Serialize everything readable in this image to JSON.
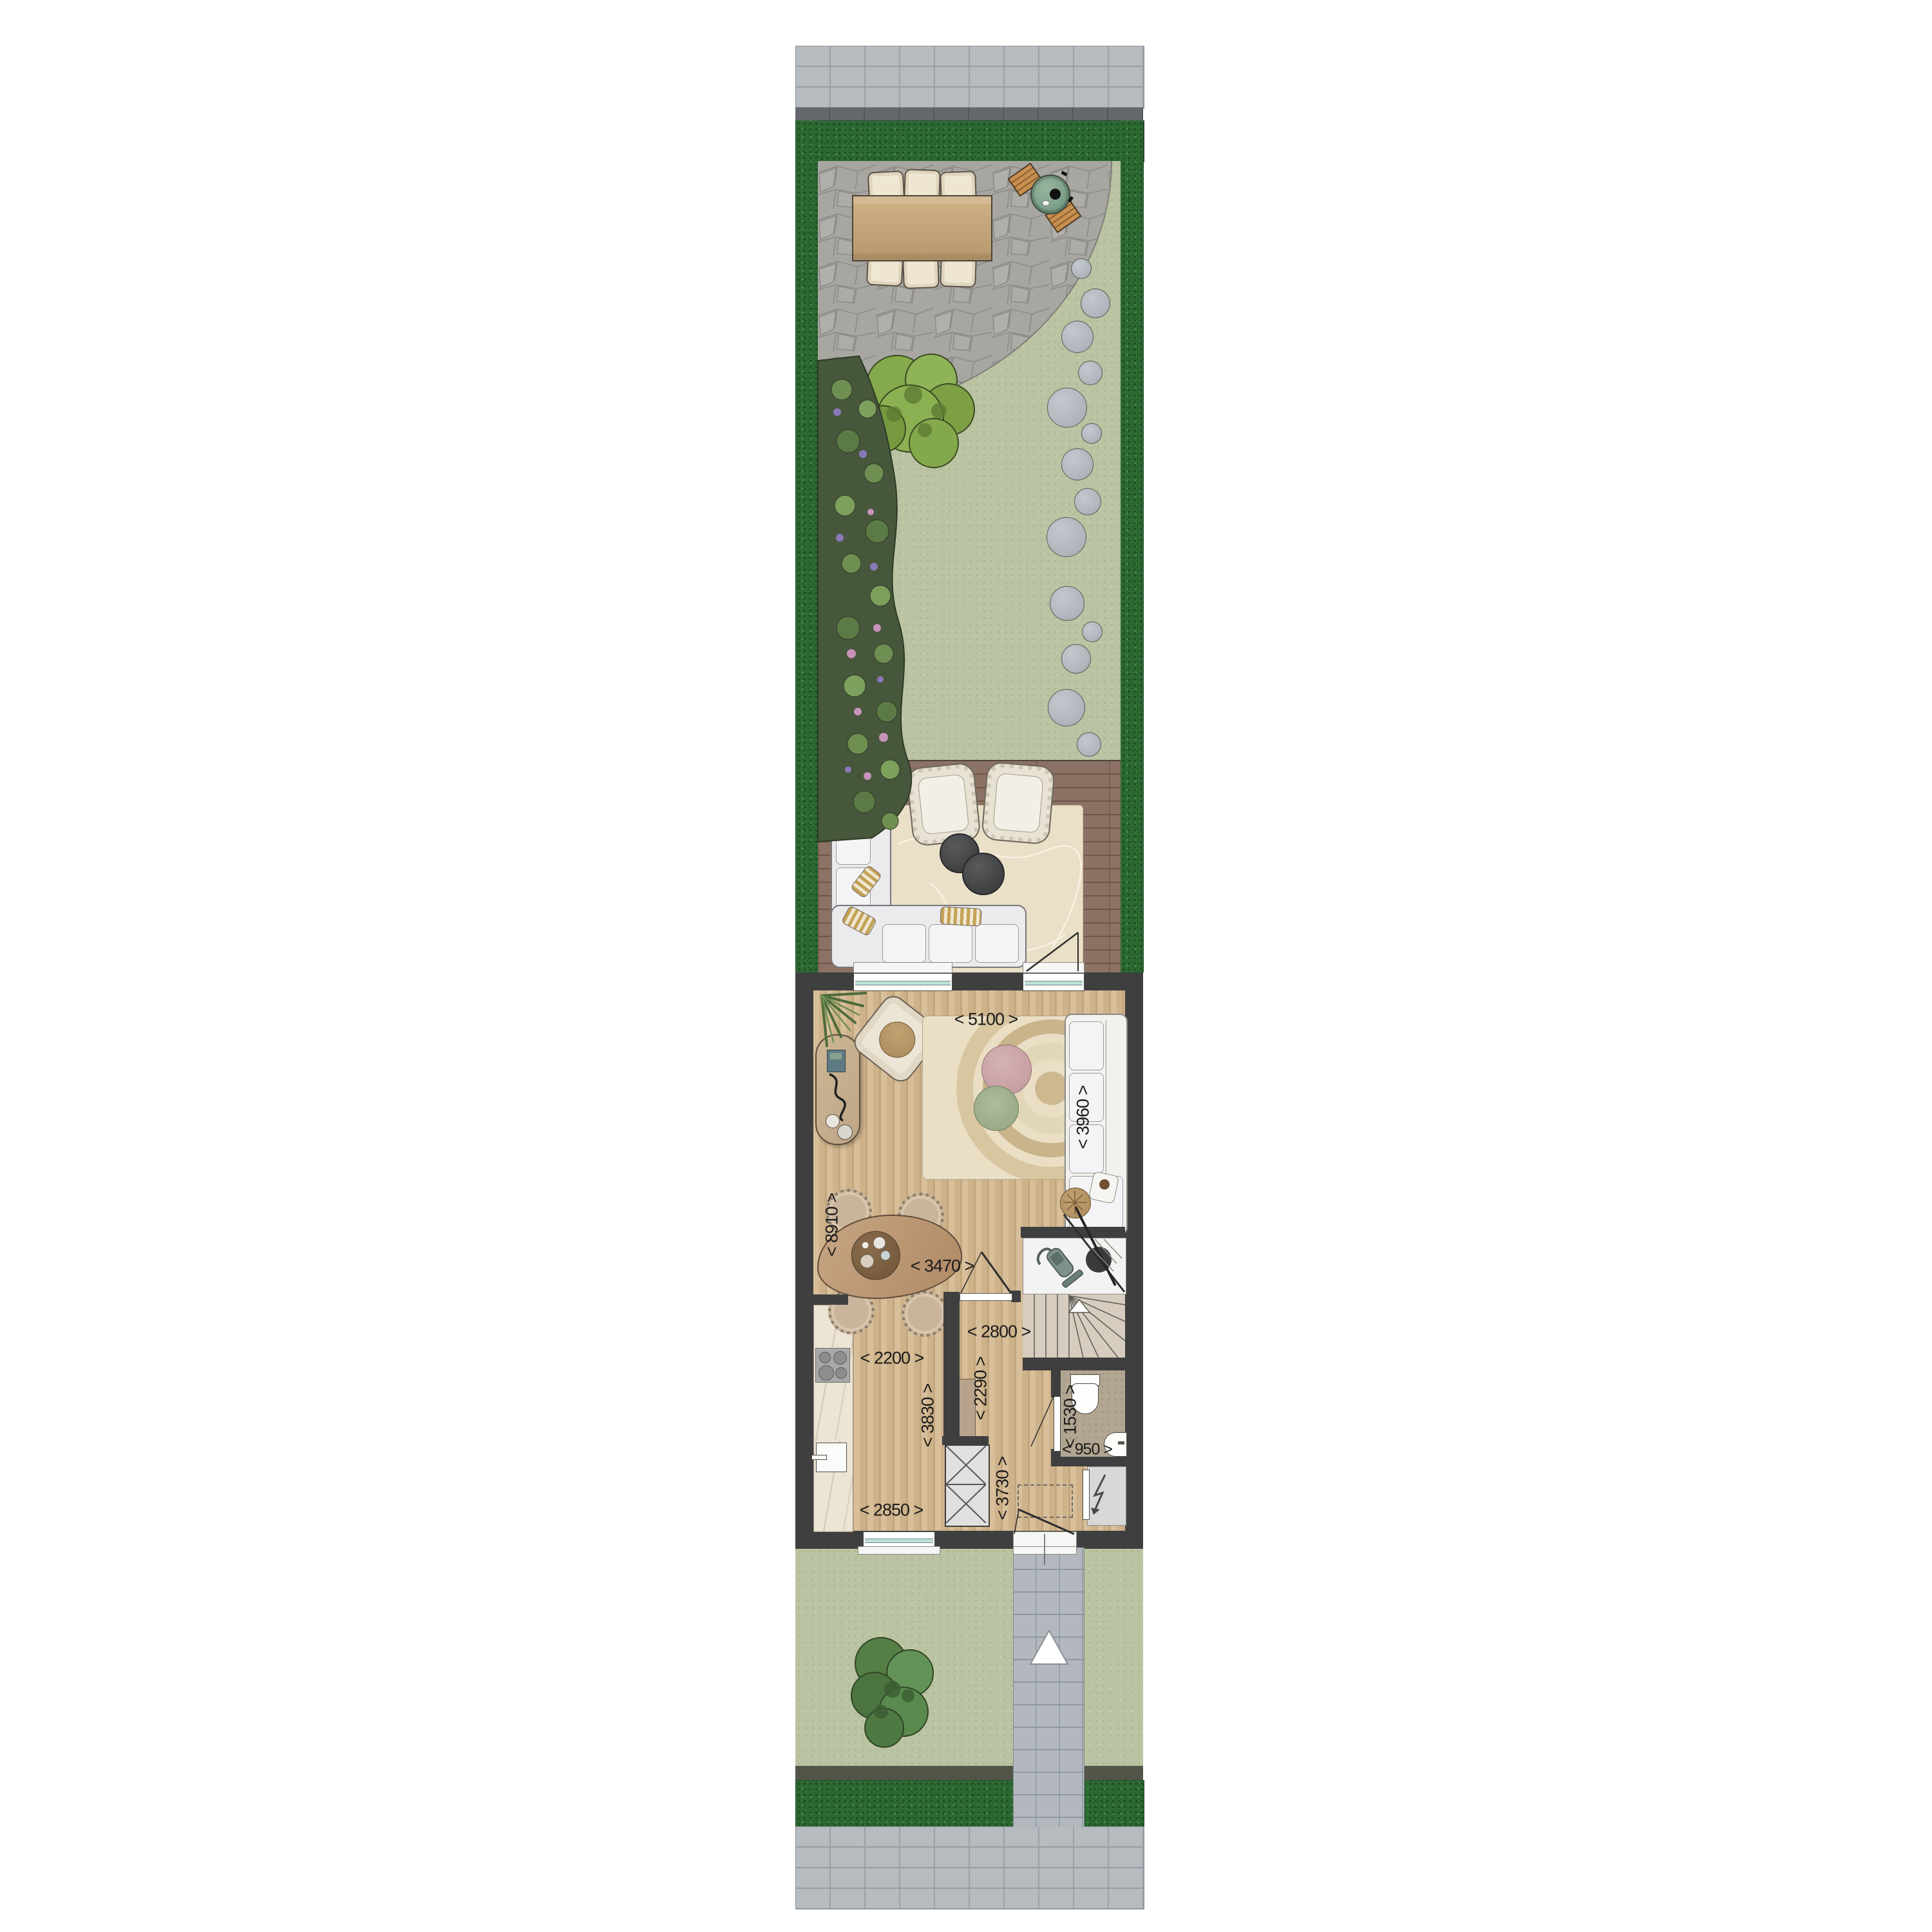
{
  "dims": {
    "living_width": "< 5100 >",
    "sofa_wall": "< 3960 >",
    "house_depth": "< 8910 >",
    "dining_width": "< 3470 >",
    "hall_width": "< 2800 >",
    "passage": "< 2290 >",
    "kitchen_width": "< 2200 >",
    "kitchen_depth": "< 3830 >",
    "kitchen_front_width": "< 2850 >",
    "hall_depth": "< 3730 >",
    "wc_depth": "< 1530 >",
    "wc_width": "< 950 >"
  },
  "icons": {
    "entrance_arrow": "white triangle pointing up on front path",
    "stair_direction_arrow": "white triangle on stair treads",
    "electric_meter": "lightning-bolt arrow in meter cupboard",
    "cooktop": "four burner circles",
    "toilet": "wc bowl with cistern",
    "vacuum_cleaner": "vacuum in under-stair closet"
  },
  "colors": {
    "wall": "#3f3f3f",
    "hedge": "#2d6a33",
    "grass": "#bac3a2",
    "patio_stone": "#a7a6a1",
    "deck": "#8c7264",
    "wood_floor": "#cfb58f",
    "sidewalk": "#b6bbc0",
    "curb": "#64686c",
    "rug_indoor": "#eadfc5",
    "rug_outdoor": "#eadfc7",
    "sofa": "#ebebee",
    "bbq_green": "#7fa28c",
    "label_text": "#1b1b1b",
    "glass": "#bfe0da"
  }
}
